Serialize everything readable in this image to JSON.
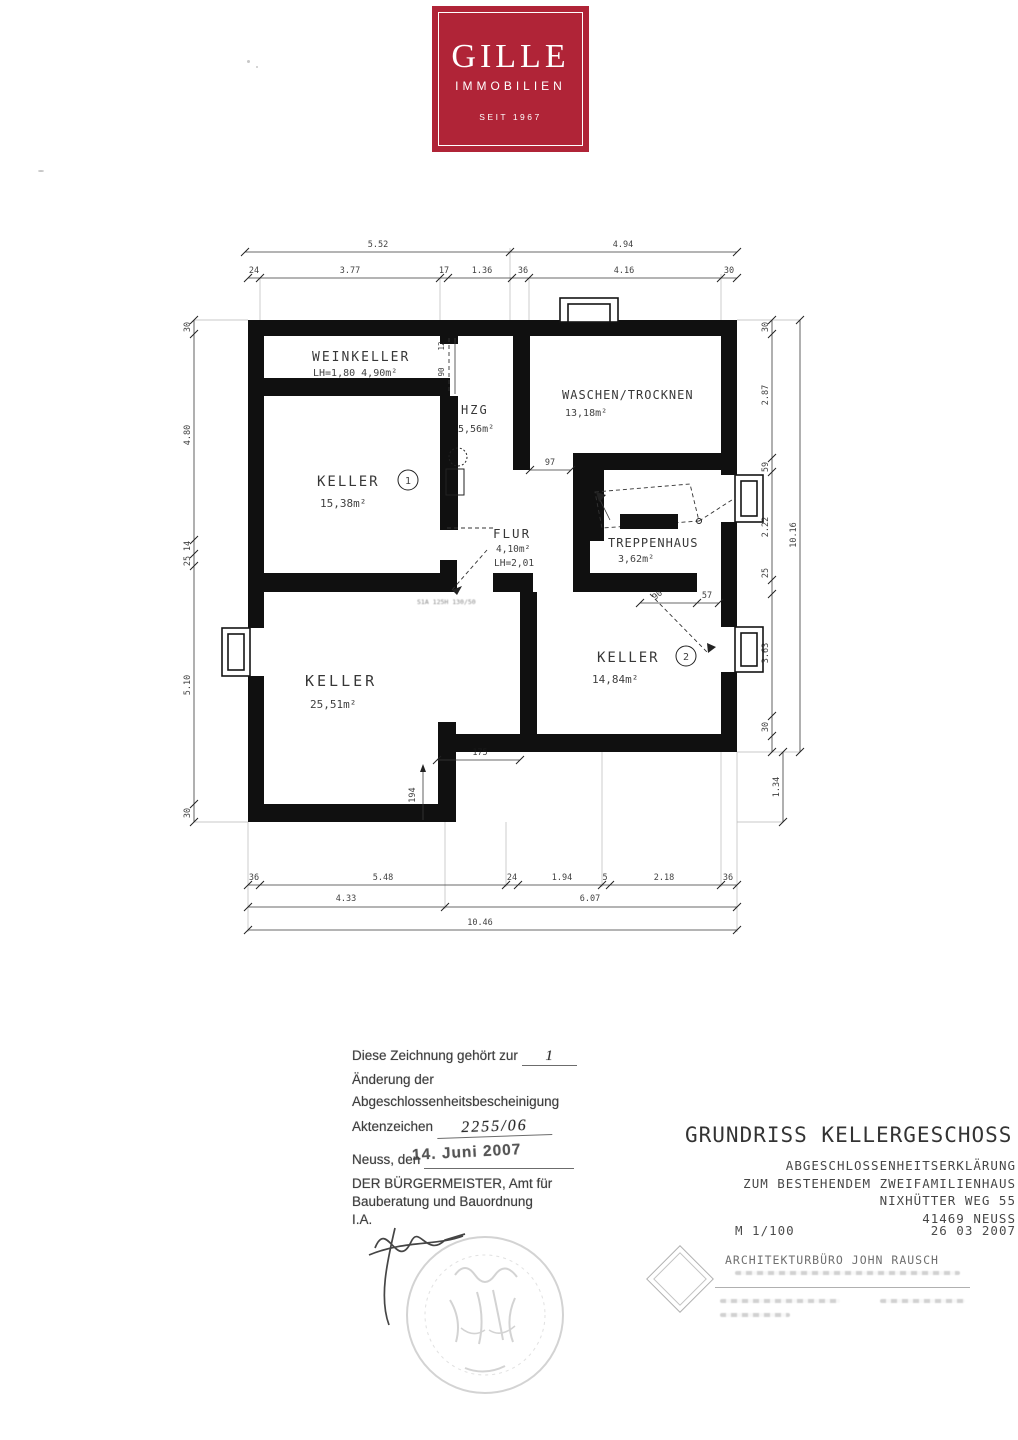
{
  "logo": {
    "name": "GILLE",
    "subtitle": "IMMOBILIEN",
    "since": "SEIT 1967",
    "color": "#b02437"
  },
  "plan": {
    "rooms": {
      "weinkeller": {
        "name": "WEINKELLER",
        "detail": "LH=1,80 4,90m²"
      },
      "hzg": {
        "name": "HZG",
        "area": "5,56m²"
      },
      "waschen": {
        "name": "WASCHEN/TROCKNEN",
        "area": "13,18m²"
      },
      "keller1": {
        "name": "KELLER",
        "number": "1",
        "area": "15,38m²"
      },
      "flur": {
        "name": "FLUR",
        "area": "4,10m²",
        "detail": "LH=2,01"
      },
      "treppenhaus": {
        "name": "TREPPENHAUS",
        "area": "3,62m²"
      },
      "keller_gross": {
        "name": "KELLER",
        "area": "25,51m²"
      },
      "keller2": {
        "name": "KELLER",
        "number": "2",
        "area": "14,84m²"
      }
    },
    "door_note": "S1A 125H 130/50",
    "dims": {
      "top1": [
        "5.52",
        "4.94"
      ],
      "top2": [
        "24",
        "3.77",
        "17",
        "1.36",
        "36",
        "4.16",
        "30"
      ],
      "bottom1": [
        "36",
        "5.48",
        "24",
        "1.94",
        "5",
        "2.18",
        "36"
      ],
      "bottom2": [
        "4.33",
        "6.07"
      ],
      "bottom3": "10.46",
      "left": [
        "30",
        "4.80",
        "14",
        "25",
        "5.10",
        "30"
      ],
      "right": [
        "30",
        "2.87",
        "59",
        "2.22",
        "25",
        "3.63",
        "30"
      ],
      "right_total": "10.16",
      "right_lower": "1.34",
      "hzg_door": [
        "12",
        "90"
      ],
      "waschen_door": "97",
      "keller2_door": [
        "90",
        "57"
      ],
      "step": [
        "175",
        "194"
      ]
    }
  },
  "notes": {
    "line1_label": "Diese Zeichnung gehört zur",
    "line1_value": "1",
    "line2": "Änderung der",
    "line3": "Abgeschlossenheitsbescheinigung",
    "line4_label": "Aktenzeichen",
    "line4_value": "2255/06",
    "line5_label": "Neuss, den",
    "line5_value": "14. Juni 2007",
    "line6": "DER BÜRGERMEISTER, Amt für",
    "line7": "Bauberatung und Bauordnung",
    "line8": "I.A."
  },
  "titleblock": {
    "title": "GRUNDRISS KELLERGESCHOSS",
    "line1": "ABGESCHLOSSENHEITSERKLÄRUNG",
    "line2": "ZUM BESTEHENDEM ZWEIFAMILIENHAUS",
    "line3": "NIXHÜTTER WEG 55",
    "line4": "41469 NEUSS",
    "scale": "M 1/100",
    "date": "26 03 2007",
    "architect": "ARCHITEKTURBÜRO JOHN RAUSCH"
  }
}
